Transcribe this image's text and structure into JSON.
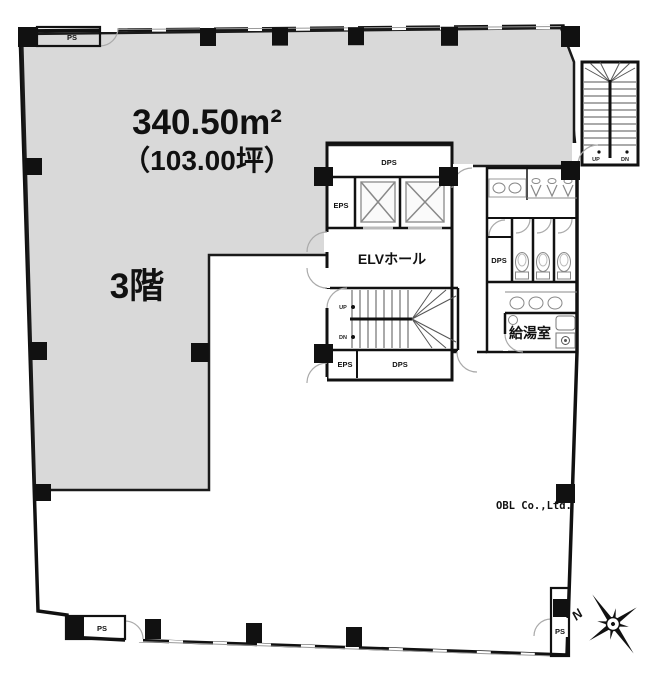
{
  "plan": {
    "area_m2": "340.50m²",
    "area_tsubo": "（103.00坪）",
    "floor": "3階",
    "rooms": {
      "elv_hall": "ELVホール",
      "kitchenette": "給湯室",
      "dps": "DPS",
      "eps": "EPS",
      "ps": "PS"
    },
    "stairs": {
      "up": "UP",
      "dn": "DN"
    },
    "compass": {
      "north": "N"
    },
    "watermark": "OBL Co.,Ltd.",
    "colors": {
      "tenant_fill": "#d9d9d9",
      "wall": "#111111",
      "fixture": "#888888",
      "background": "#ffffff"
    }
  }
}
